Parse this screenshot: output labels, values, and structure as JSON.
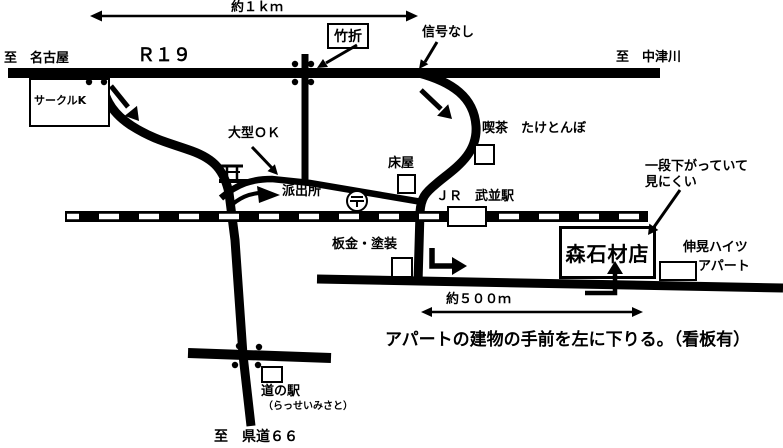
{
  "page": {
    "background": "#ffffff",
    "ink": "#000000"
  },
  "header": {
    "to_left": "至　名古屋",
    "route": "Ｒ１９",
    "distance": "約１ｋｍ",
    "junction_box": "竹折",
    "no_signal": "信号なし",
    "to_right": "至　中津川"
  },
  "landmarks": {
    "circle_k": "サークルK",
    "large_ok": "大型ＯＫ",
    "police_box": "派出所",
    "barber": "床屋",
    "cafe": "喫茶　たけとんぼ",
    "jr_station": "ＪＲ　武並駅",
    "body_shop": "板金・塗装",
    "apartment_line1": "伸晃ハイツ",
    "apartment_line2": "アパート",
    "roadside_station": "道の駅",
    "roadside_station_sub": "（らっせいみさと）",
    "post_symbol": "〒"
  },
  "destination": {
    "name": "森石材店",
    "note_line1": "一段下がっていて",
    "note_line2": "見にくい",
    "distance": "約５００ｍ",
    "instruction": "アパートの建物の手前を左に下りる。（看板有）"
  },
  "footer": {
    "to_bottom": "至　県道６６"
  },
  "icons": {
    "shrine": "torii-shrine-icon",
    "post_office": "post-office-icon",
    "railway": "railway-track",
    "crossing_dots": "signal-corner-dots"
  }
}
